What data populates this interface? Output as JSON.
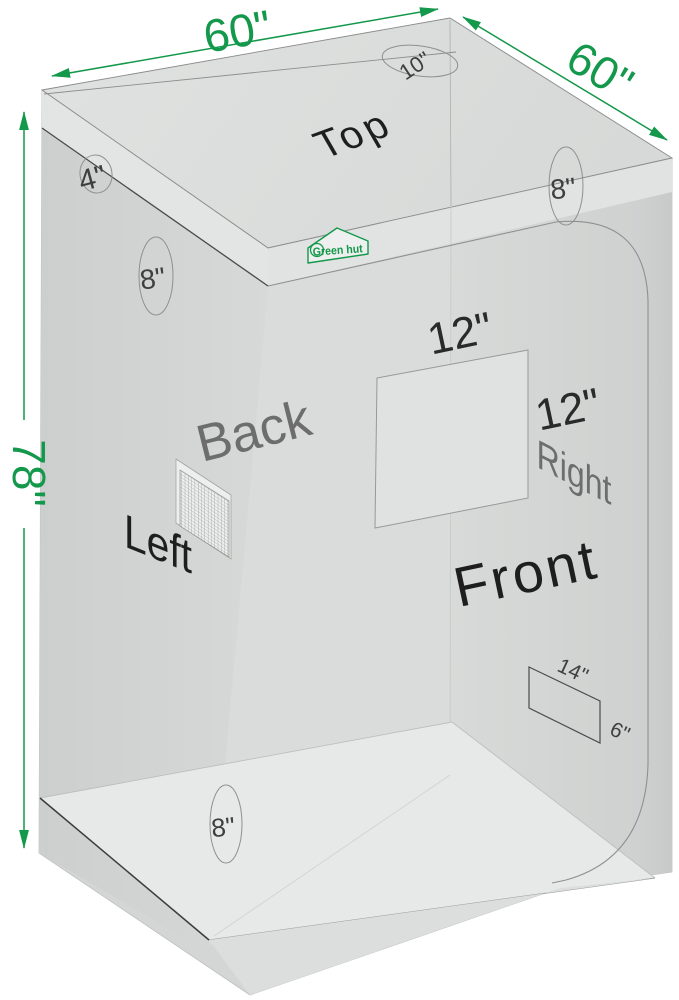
{
  "diagram": {
    "brand": "Green hut",
    "dims": {
      "width": "60\"",
      "depth": "60\"",
      "height": "78\""
    },
    "faces": {
      "top": "Top",
      "back": "Back",
      "left": "Left",
      "front": "Front",
      "right": "Right"
    },
    "ports": {
      "top_duct": "10\"",
      "corner_vent": "4\"",
      "left_upper": "8\"",
      "right_upper": "8\"",
      "left_lower": "8\""
    },
    "window": {
      "width": "12\"",
      "height": "12\""
    },
    "floor_vent": {
      "width": "14\"",
      "height": "6\""
    },
    "colors": {
      "accent_green": "#14984b",
      "label_dark": "#1e1e1e",
      "label_gray": "#6d6d6d"
    }
  }
}
